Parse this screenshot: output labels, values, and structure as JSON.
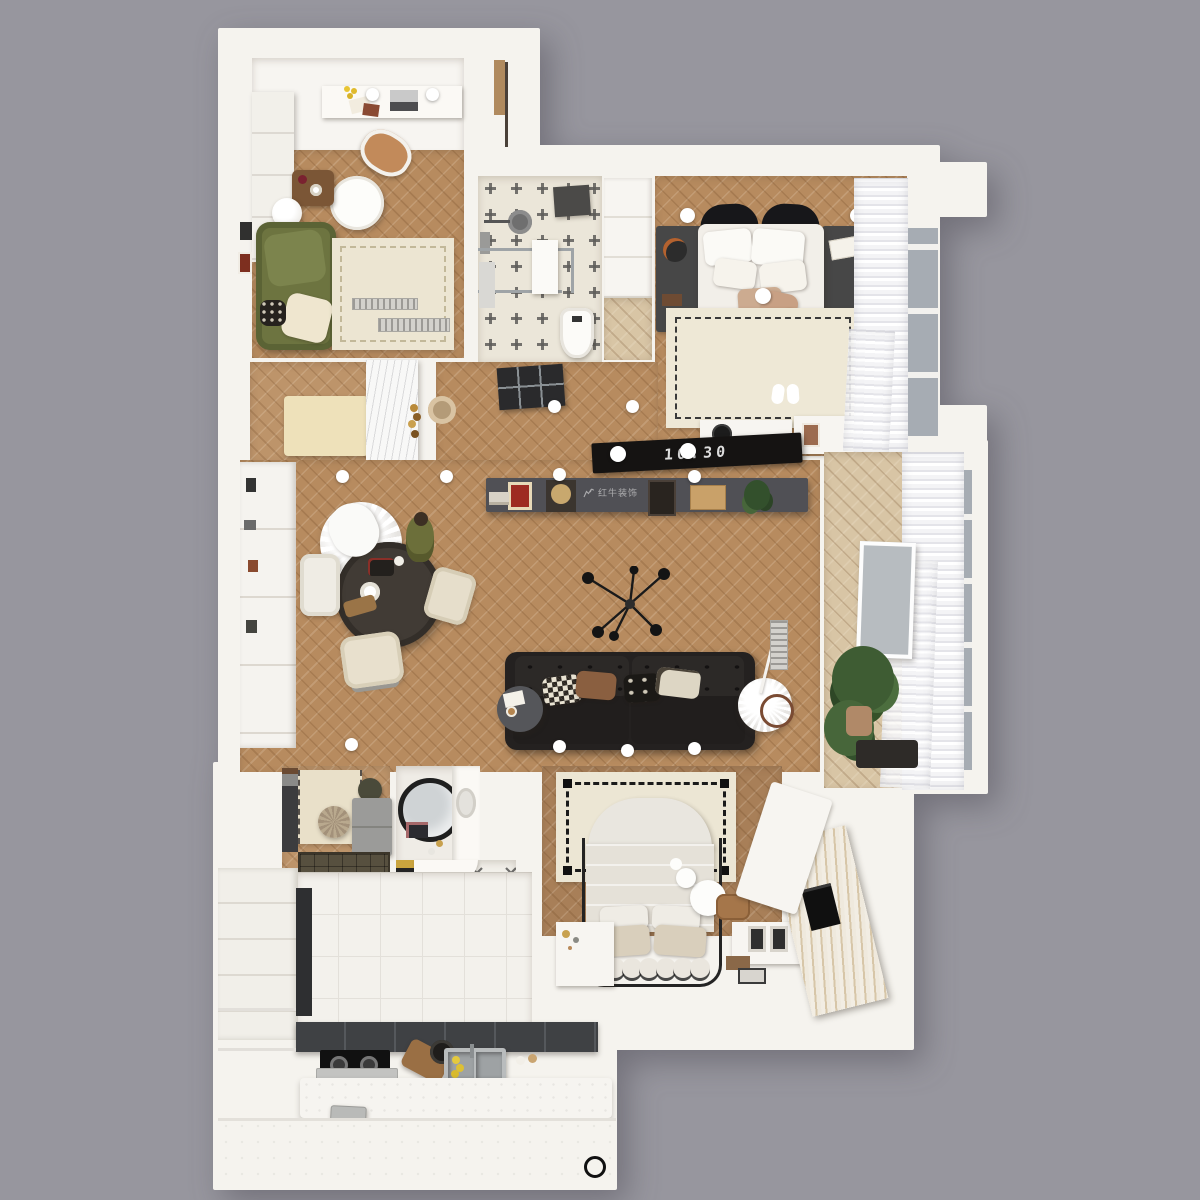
{
  "scene": {
    "type": "3d-apartment-floor-plan-top-view",
    "background": "#97969e"
  },
  "watermark": {
    "brand_text": "红牛装饰"
  },
  "tv": {
    "time_text": "10:30"
  },
  "colors": {
    "background": "#97969e",
    "walls": "#f5f3ee",
    "wood_floor": "#b78b5f",
    "pale_wood": "#d8c5a5",
    "dark_console": "#505055",
    "sofa_black": "#242120",
    "sofa_green": "#6d7440",
    "rug_cream": "#ece5d2",
    "tile_cream": "#ebe6d9",
    "tile_white": "#f3f1ec",
    "curtain_white": "#f7f7f9",
    "window_glass": "#a6acb3",
    "lemon_yellow": "#e4c93e",
    "plant_green": "#3e5c33",
    "blanket_gray": "#676d66",
    "throw_beige": "#c8a084"
  }
}
